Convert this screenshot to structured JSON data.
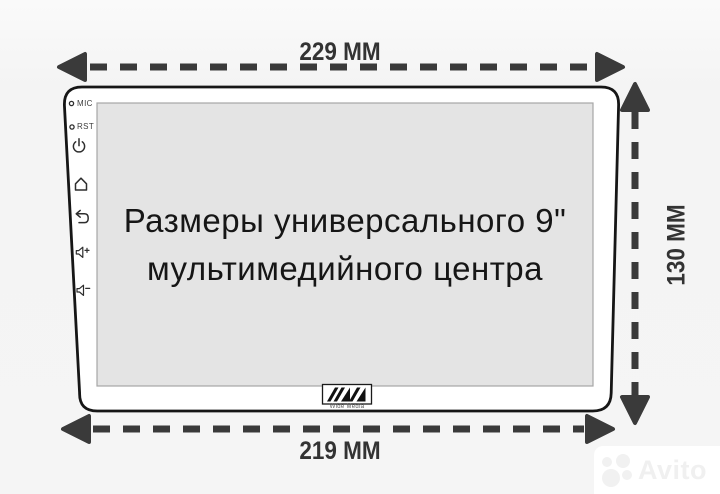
{
  "dimensions": {
    "top_label": "229 MM",
    "bottom_label": "219 MM",
    "right_label": "130 MM"
  },
  "device": {
    "controls": {
      "mic_label": "MIC",
      "rst_label": "RST",
      "icons": [
        "power-icon",
        "home-icon",
        "back-icon",
        "volume-up-icon",
        "volume-down-icon"
      ]
    },
    "screen_text": {
      "line1": "Размеры универсального 9\"",
      "line2": "мультимедийного центра"
    },
    "brand_label": "Wide Media"
  },
  "watermark": {
    "brand": "Avito"
  },
  "colors": {
    "background": "#f5f5f5",
    "dimension_ink": "#3a3a3a",
    "device_outline": "#161616",
    "device_fill": "#ffffff",
    "screen_fill": "#e4e4e4",
    "screen_border": "#a6a6a6",
    "watermark_bg": "#ffffff",
    "watermark_fg": "#f0f0f0"
  }
}
